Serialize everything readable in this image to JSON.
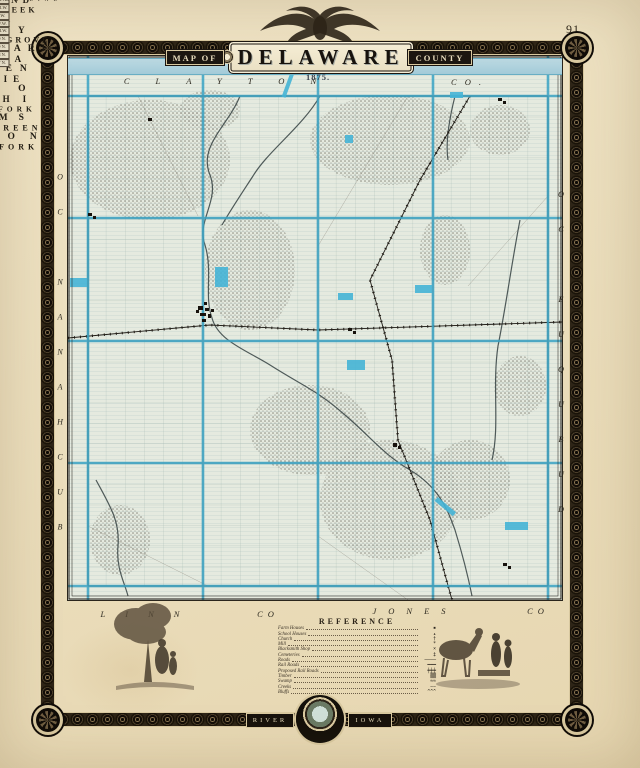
{
  "page_number": "91",
  "title": {
    "map_of": "MAP OF",
    "name": "DELAWARE",
    "county": "COUNTY",
    "year": "1875."
  },
  "border": {
    "left_word": "RIVER",
    "right_word": "IOWA"
  },
  "surround": {
    "top": "CLAYTON",
    "top_co": "CO.",
    "left": "BUCHANAN CO",
    "right": "DUBUQUE CO",
    "bottom_left": "LINN",
    "bottom_left_co": "CO",
    "bottom_right": "JONES",
    "bottom_right_co": "CO"
  },
  "townships": [
    {
      "name": "RICHLAND",
      "x": 152,
      "y": 143,
      "fs": 9,
      "ls": 5
    },
    {
      "name": "HONEY CREEK",
      "x": 252,
      "y": 160,
      "fs": 8,
      "ls": 3
    },
    {
      "name": "ELK",
      "x": 388,
      "y": 148,
      "fs": 10,
      "ls": 22
    },
    {
      "name": "COLONY",
      "x": 505,
      "y": 172,
      "fs": 9,
      "ls": 8
    },
    {
      "name": "COFFINS GROVE",
      "x": 148,
      "y": 244,
      "fs": 8,
      "ls": 3
    },
    {
      "name": "DELAWARE",
      "x": 253,
      "y": 248,
      "fs": 9.5,
      "ls": 7
    },
    {
      "name": "ONEIDA",
      "x": 386,
      "y": 247,
      "fs": 9,
      "ls": 8
    },
    {
      "name": "BREMEN",
      "x": 510,
      "y": 279,
      "fs": 9.5,
      "ls": 8
    },
    {
      "name": "PRAIRIE",
      "x": 151,
      "y": 400,
      "fs": 9,
      "ls": 6
    },
    {
      "name": "MILO",
      "x": 262,
      "y": 401,
      "fs": 9.5,
      "ls": 18
    },
    {
      "name": "DELHI",
      "x": 396,
      "y": 426,
      "fs": 9,
      "ls": 13
    },
    {
      "name": "NORTH FORK",
      "x": 505,
      "y": 428,
      "fs": 7.5,
      "ls": 4
    },
    {
      "name": "ADAMS",
      "x": 150,
      "y": 528,
      "fs": 9.5,
      "ls": 11
    },
    {
      "name": "HAZELGREEN",
      "x": 268,
      "y": 528,
      "fs": 8,
      "ls": 4
    },
    {
      "name": "UNION",
      "x": 376,
      "y": 528,
      "fs": 9.5,
      "ls": 15
    },
    {
      "name": "SOUTH FORK",
      "x": 515,
      "y": 510,
      "fs": 8,
      "ls": 4
    }
  ],
  "edge_labels": [
    {
      "label": "R.VI.W.",
      "x": 125,
      "y": 88
    },
    {
      "label": "R.VI.W.",
      "x": 168,
      "y": 607
    },
    {
      "label": "R.V.W.",
      "x": 257,
      "y": 607
    },
    {
      "label": "R.IV.W.",
      "x": 403,
      "y": 607
    },
    {
      "label": "R.III.W.",
      "x": 525,
      "y": 604
    },
    {
      "label": "T.90 N.",
      "x": 51,
      "y": 143
    },
    {
      "label": "T.89 N.",
      "x": 51,
      "y": 265
    },
    {
      "label": "T.88 N.",
      "x": 51,
      "y": 393
    },
    {
      "label": "T.87 N.",
      "x": 51,
      "y": 520
    }
  ],
  "annotations": [
    {
      "name": "CORRECTION LINE",
      "x": 215,
      "y": 344,
      "fs": 5.5,
      "ls": 5
    },
    {
      "name": "MANCHESTER",
      "x": 226,
      "y": 313,
      "fs": 4.5,
      "ls": 1
    },
    {
      "name": "Grove Creek",
      "x": 378,
      "y": 597,
      "fs": 4,
      "ls": 0.5
    }
  ],
  "legend": {
    "title": "REFERENCE",
    "items": [
      {
        "label": "Farm Houses",
        "symbol": "▪"
      },
      {
        "label": "School Houses",
        "symbol": "▴"
      },
      {
        "label": "Church",
        "symbol": "†"
      },
      {
        "label": "Mill",
        "symbol": "*"
      },
      {
        "label": "Blacksmith Shop",
        "symbol": "×"
      },
      {
        "label": "Cemeteries",
        "symbol": "‡"
      },
      {
        "label": "Roads",
        "symbol": "────"
      },
      {
        "label": "Rail Roads",
        "symbol": "━━━"
      },
      {
        "label": "Proposed Rail Roads",
        "symbol": "╪╪╪"
      },
      {
        "label": "Timber",
        "symbol": "▒▒"
      },
      {
        "label": "Swamp",
        "symbol": "≈≈"
      },
      {
        "label": "Creeks",
        "symbol": "∼∼"
      },
      {
        "label": "Bluffs",
        "symbol": "^^^"
      }
    ]
  }
}
